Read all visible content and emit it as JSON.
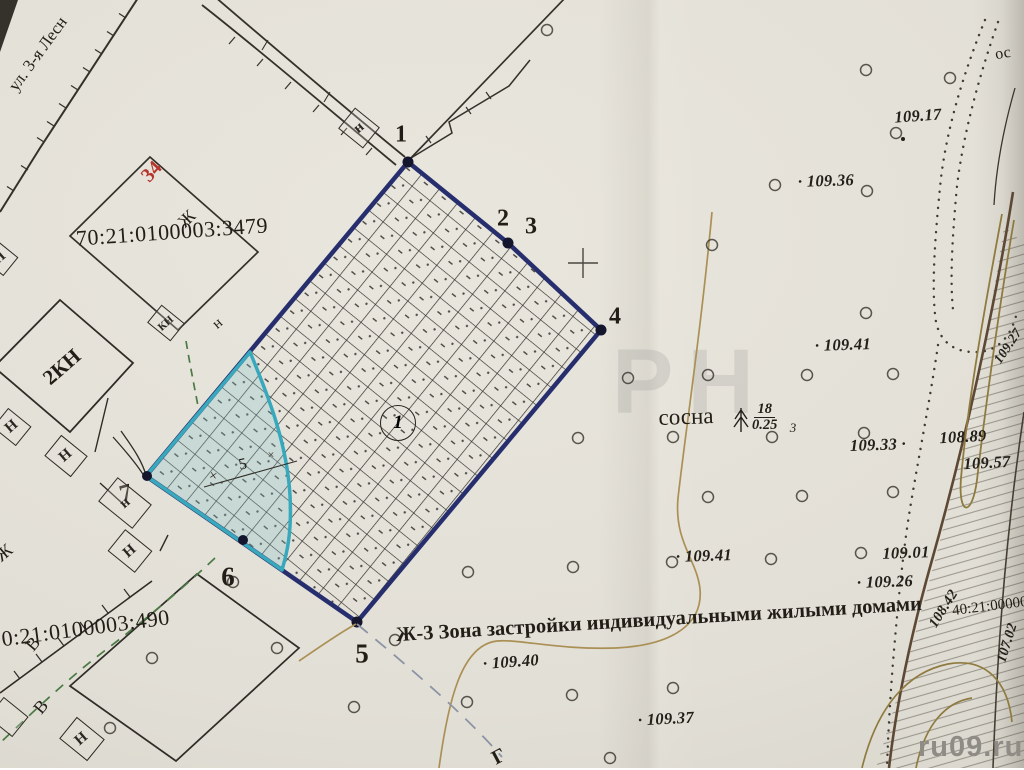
{
  "map": {
    "street": {
      "label": "ул. 3-я Лесн"
    },
    "corner_text": "ос",
    "watermark_large": "РН",
    "site_watermark": "ru09.ru",
    "zone_label": "Ж-3 Зона застройки индивидуальными жилыми домами",
    "cadastral": {
      "parcel_upper": "70:21:0100003:3479",
      "parcel_lower": "70:21:0100003:490",
      "parcel_right": "40:21:00000"
    },
    "house_number": "34",
    "letters": {
      "zh": "Ж",
      "v": "В",
      "n_upper": "Н",
      "n_lower": "н",
      "kn": "КН",
      "kn2": "2КН",
      "g": "Г",
      "os": "ос"
    },
    "pine": {
      "label": "сосна",
      "height": "18",
      "diameter": "0.25",
      "spacing": "3"
    },
    "vertices": [
      "1",
      "2",
      "3",
      "4",
      "5",
      "6",
      "7"
    ],
    "circled_label": "1",
    "marks": {
      "cross": "×",
      "five": "5"
    },
    "elevations": [
      "109.17",
      "· 109.36",
      "· 109.41",
      "109.33 ·",
      "108.89",
      "109.57",
      "109.01",
      "· 109.26",
      "· 109.41",
      "· 109.40",
      "· 109.37",
      "108.42",
      "107.02",
      "109.27"
    ]
  }
}
